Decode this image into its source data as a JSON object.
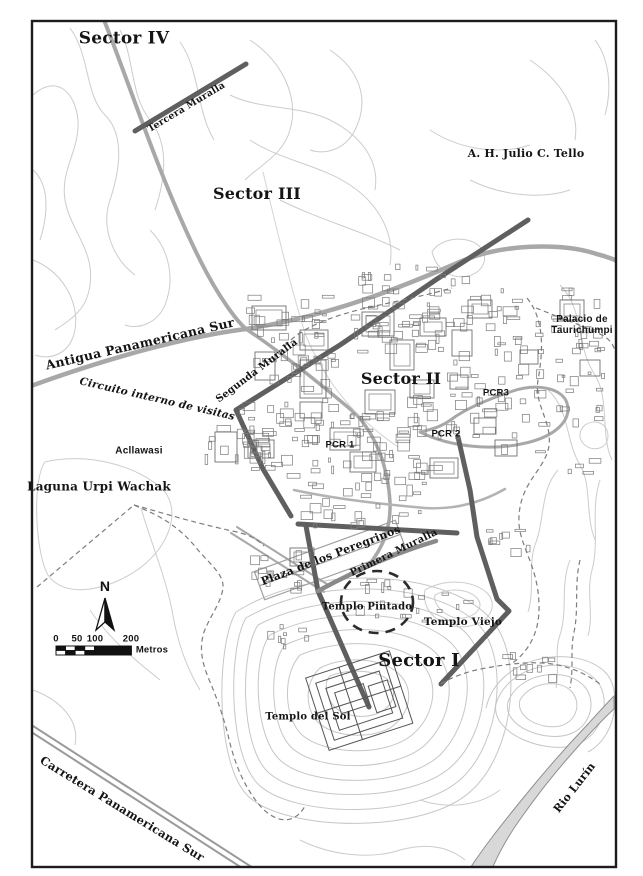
{
  "map": {
    "labels": [
      {
        "id": "sector-iv",
        "text": "Sector IV",
        "x": 124,
        "y": 39,
        "rot": 0,
        "size": 17,
        "font": "serif"
      },
      {
        "id": "tercera-muralla",
        "text": "Tercera Muralla",
        "x": 187,
        "y": 108,
        "rot": -31,
        "size": 9.5,
        "font": "serif"
      },
      {
        "id": "sector-iii",
        "text": "Sector III",
        "x": 257,
        "y": 194,
        "rot": 0,
        "size": 16,
        "font": "serif"
      },
      {
        "id": "ah-julio-c-tello",
        "text": "A. H. Julio C. Tello",
        "x": 526,
        "y": 154,
        "rot": 0,
        "size": 11,
        "font": "serif"
      },
      {
        "id": "antigua-panamericana-sur",
        "text": "Antigua Panamericana Sur",
        "x": 140,
        "y": 344,
        "rot": -13,
        "size": 12.5,
        "font": "serif"
      },
      {
        "id": "segunda-muralla",
        "text": "Segunda Muralla",
        "x": 257,
        "y": 371,
        "rot": -37,
        "size": 10,
        "font": "serif"
      },
      {
        "id": "circuito-interno-de-visitas",
        "text": "Circuito interno de visitas",
        "x": 157,
        "y": 400,
        "rot": 13,
        "size": 10.5,
        "font": "serif",
        "italic": true
      },
      {
        "id": "sector-ii",
        "text": "Sector II",
        "x": 401,
        "y": 379,
        "rot": 0,
        "size": 16,
        "font": "serif"
      },
      {
        "id": "pcr3",
        "text": "PCR3",
        "x": 496,
        "y": 394,
        "rot": 0,
        "size": 9.5,
        "font": "sans"
      },
      {
        "id": "pcr1",
        "text": "PCR 1",
        "x": 340,
        "y": 446,
        "rot": 0,
        "size": 9.5,
        "font": "sans"
      },
      {
        "id": "pcr2",
        "text": "PCR 2",
        "x": 446,
        "y": 435,
        "rot": 0,
        "size": 9.5,
        "font": "sans"
      },
      {
        "id": "palacio-de-taurichumpi",
        "text": "Palacio de\nTaurichumpi",
        "x": 582,
        "y": 325,
        "rot": 0,
        "size": 10,
        "font": "sans"
      },
      {
        "id": "acllawasi",
        "text": "Acllawasi",
        "x": 139,
        "y": 451,
        "rot": 0,
        "size": 10,
        "font": "sans"
      },
      {
        "id": "laguna-urpi-wachak",
        "text": "Laguna Urpi Wachak",
        "x": 99,
        "y": 487,
        "rot": 0,
        "size": 12,
        "font": "serif"
      },
      {
        "id": "plaza-de-los-peregrinos",
        "text": "Plaza de los Peregrinos",
        "x": 331,
        "y": 556,
        "rot": -21,
        "size": 11,
        "font": "serif"
      },
      {
        "id": "primera-muralla",
        "text": "Primera Muralla",
        "x": 394,
        "y": 553,
        "rot": -26,
        "size": 10,
        "font": "serif"
      },
      {
        "id": "templo-pintado",
        "text": "Templo Pintado",
        "x": 367,
        "y": 607,
        "rot": 0,
        "size": 10,
        "font": "serif"
      },
      {
        "id": "templo-viejo",
        "text": "Templo Viejo",
        "x": 463,
        "y": 623,
        "rot": 0,
        "size": 10.5,
        "font": "serif"
      },
      {
        "id": "sector-i",
        "text": "Sector I",
        "x": 419,
        "y": 661,
        "rot": 0,
        "size": 18,
        "font": "serif"
      },
      {
        "id": "templo-del-sol",
        "text": "Templo del Sol",
        "x": 308,
        "y": 717,
        "rot": 0,
        "size": 10,
        "font": "serif"
      },
      {
        "id": "carretera-panamericana-sur",
        "text": "Carretera Panamericana Sur",
        "x": 122,
        "y": 809,
        "rot": 31.5,
        "size": 11.5,
        "font": "serif"
      },
      {
        "id": "rio-lurin",
        "text": "Rio Lurín",
        "x": 575,
        "y": 788,
        "rot": -52,
        "size": 11,
        "font": "serif"
      },
      {
        "id": "north-n",
        "text": "N",
        "x": 105,
        "y": 587,
        "rot": 0,
        "size": 14,
        "font": "sans"
      },
      {
        "id": "scale-0",
        "text": "0",
        "x": 56,
        "y": 640,
        "rot": 0,
        "size": 9.5,
        "font": "sans"
      },
      {
        "id": "scale-50",
        "text": "50",
        "x": 77,
        "y": 640,
        "rot": 0,
        "size": 9.5,
        "font": "sans"
      },
      {
        "id": "scale-100",
        "text": "100",
        "x": 95,
        "y": 640,
        "rot": 0,
        "size": 9.5,
        "font": "sans"
      },
      {
        "id": "scale-200",
        "text": "200",
        "x": 131,
        "y": 640,
        "rot": 0,
        "size": 9.5,
        "font": "sans"
      },
      {
        "id": "scale-metros",
        "text": "Metros",
        "x": 152,
        "y": 651,
        "rot": 0,
        "size": 9.5,
        "font": "sans"
      }
    ],
    "north_arrow": {
      "label": "N"
    },
    "scale_bar": {
      "tick_labels": [
        "0",
        "50",
        "100",
        "200"
      ],
      "unit_label": "Metros"
    },
    "colors": {
      "frame": "#1c1c1c",
      "contour": "#cccccc",
      "road": "#a8a8a8",
      "wall": "#5f5f5f",
      "river_fill": "#d8d8d8",
      "label_text": "#141414"
    }
  }
}
